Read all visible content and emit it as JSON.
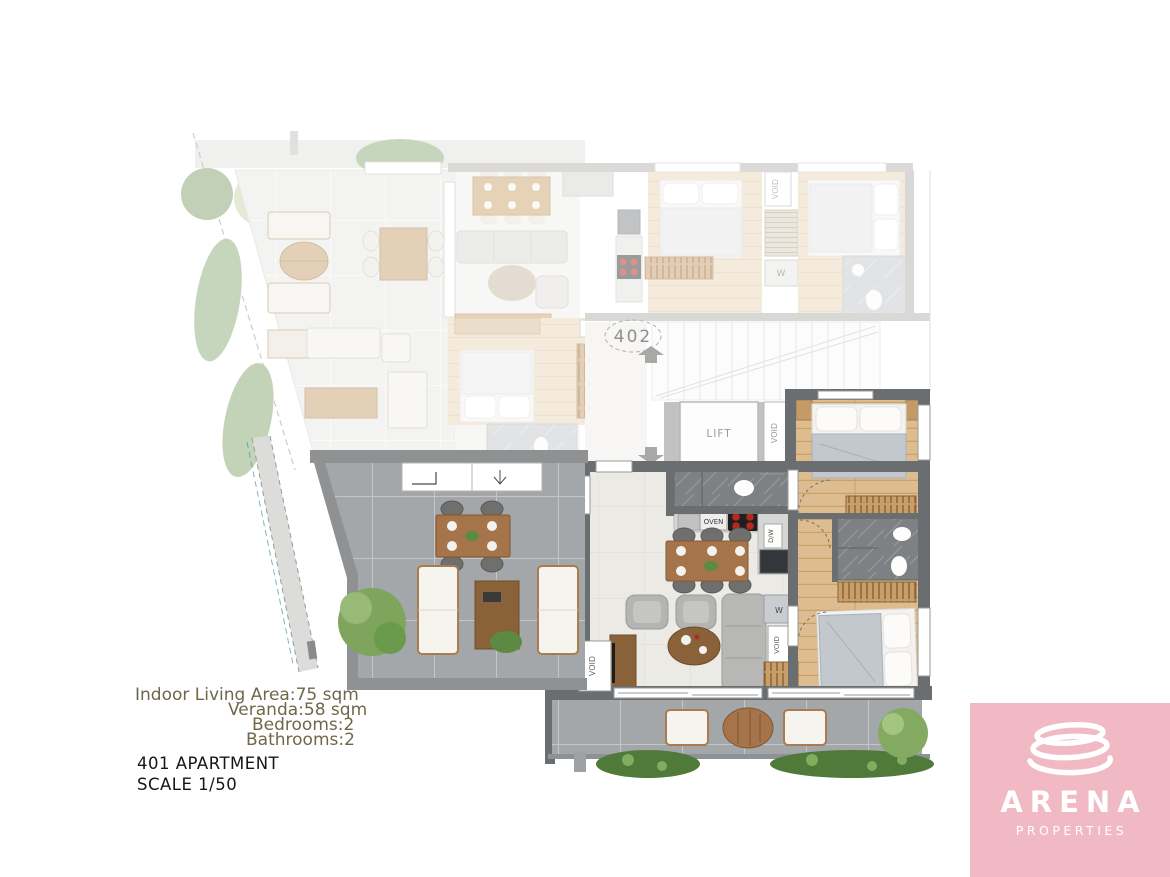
{
  "plan": {
    "labels": {
      "apt402": "402",
      "apt401": "401",
      "lift": "LIFT",
      "void": "VOID",
      "oven": "OVEN",
      "washer": "W",
      "dishwasher": "D/W"
    },
    "info": {
      "area_line": "Indoor Living Area:75 sqm",
      "veranda_line": "Veranda:58 sqm",
      "bedrooms_line": "Bedrooms:2",
      "bathrooms_line": "Bathrooms:2",
      "title": "401 APARTMENT",
      "scale": "SCALE 1/50"
    },
    "colors": {
      "accent_pink": "#f0b9c3",
      "info_text": "#6e684a",
      "wall_dark": "#6b6e71",
      "hob_burner": "#b5271f"
    }
  },
  "logo": {
    "brand": "ARENA",
    "tagline": "PROPERTIES"
  }
}
